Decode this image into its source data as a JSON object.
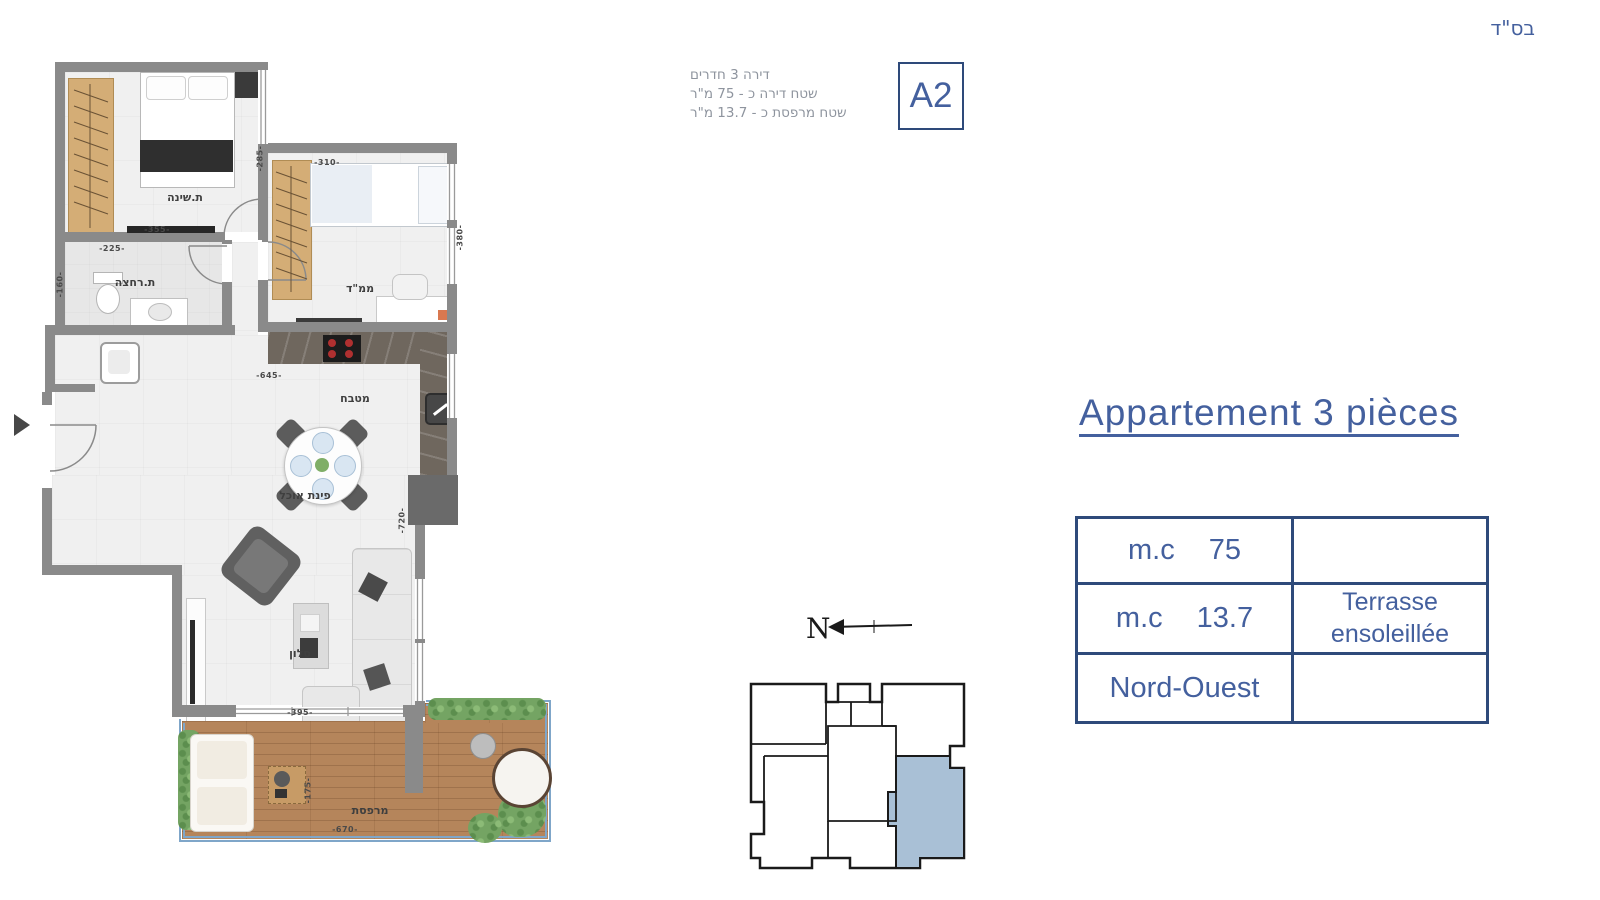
{
  "meta": {
    "bsd": "בס\"ד"
  },
  "header": {
    "info_lines": [
      "דירה 3 חדרים",
      "שטח דירה כ - 75 מ\"ר",
      "שטח מרפסת כ - 13.7 מ\"ר"
    ],
    "unit_badge": "A2"
  },
  "plan": {
    "rooms": {
      "bedroom": "ת.שינה",
      "bathroom": "ת.רחצה",
      "mamad": "ממ\"ד",
      "kitchen": "מטבח",
      "dining": "פינת אוכל",
      "living": "סלון",
      "terrace": "מרפסת"
    },
    "dims": {
      "bedroom_w": "-355-",
      "bedroom_h": "-285-",
      "bath_w": "-225-",
      "bath_h": "-160-",
      "mamad_w": "-310-",
      "mamad_h": "-380-",
      "kitchen_w": "-645-",
      "living_h": "-720-",
      "living_w": "-395-",
      "terrace_w": "-670-",
      "terrace_h": "-175-"
    }
  },
  "keyplan": {
    "north_label": "N"
  },
  "details": {
    "title": "Appartement 3 pièces",
    "table": {
      "rows": [
        {
          "label": "m.c",
          "value": "75",
          "right_line1": "",
          "right_line2": ""
        },
        {
          "label": "m.c",
          "value": "13.7",
          "right_line1": "Terrasse",
          "right_line2": "ensoleillée"
        },
        {
          "label": "Nord-Ouest",
          "value": "",
          "right_line1": "",
          "right_line2": ""
        }
      ]
    }
  },
  "colors": {
    "accent": "#44609e",
    "tableBorder": "#2e4a7a",
    "infoGray": "#8e949e",
    "wall": "#8a8a8a",
    "wallDark": "#6a6a6a",
    "floor": "#f0f0f0",
    "wood": "#d4ad76",
    "deck": "#b5855b",
    "counter": "#6f675e",
    "plant": "#74a463",
    "railing": "#7fa6c9",
    "highlight": "#a9c0d6",
    "labelInk": "#3f3f3f"
  }
}
